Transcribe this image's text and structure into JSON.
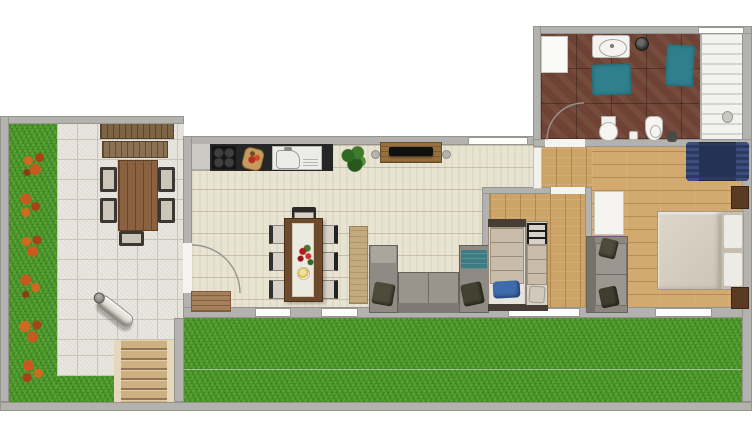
{
  "scene": {
    "kind": "apartment-floor-plan",
    "view": "top-down 2D architectural render",
    "text_labels": []
  },
  "rooms": {
    "garden": "Side garden with flower bed",
    "patio": "Paved patio",
    "garden_stairs": "Garden stairs",
    "lawn": "Back lawn",
    "living": "Open-plan kitchen, dining and living room",
    "hallway": "Hallway",
    "kids_bedroom": "Bedroom with two single beds",
    "master_bedroom": "Master bedroom",
    "bathroom": "Bathroom with shower"
  },
  "furniture": {
    "garden_bench": "Wooden garden bench set",
    "outdoor_table": "Outdoor dining table with chairs",
    "person": "Person walking on patio",
    "flower_bed": "Orange flower clusters",
    "kitchen_counter": "Kitchen counter",
    "hob": "Cooktop with four burners",
    "cutting_board": "Cutting board with food",
    "sink": "Kitchen sink unit",
    "plant": "Green potted plant",
    "sideboard": "TV sideboard",
    "tv": "Flat TV on sideboard",
    "dining_table": "Dining table with runner, flowers and bowl",
    "dining_chairs": "Seven dining chairs",
    "console": "Wooden console table",
    "sofa": "U-shaped grey corner sofa with cushions and teal blanket",
    "entry_mat": "Entry door mat",
    "kids_bed_large": "Single bed with blue pillow",
    "kids_bed_small": "Narrow bed with bunk ladder",
    "wardrobe": "White wardrobe / open door",
    "bedroom_sofa": "Two-seat grey sofa",
    "double_bed": "Double bed with two pillows",
    "nightstands": "Two dark wood nightstands",
    "armchair": "Navy blue lounge chair",
    "vanity": "Washbasin vanity",
    "bath_mats": "Two teal bath mats",
    "toilet": "Toilet",
    "bidet": "Bidet",
    "shower": "Walk-in shower with slatted deck",
    "laundry_box": "White cabinet"
  },
  "palette": {
    "grass": "#4f9b2d",
    "travertine": "#e9e3d2",
    "wood_floor": "#cda468",
    "bath_tile": "#6e4234",
    "wall": "#b4b2ae",
    "counter": "#262626",
    "sofa_grey": "#8f8a83",
    "teal": "#2f7f8d",
    "navy": "#2c3a60",
    "pillow_blue": "#3e6cab",
    "flower_orange": "#c2541e"
  }
}
